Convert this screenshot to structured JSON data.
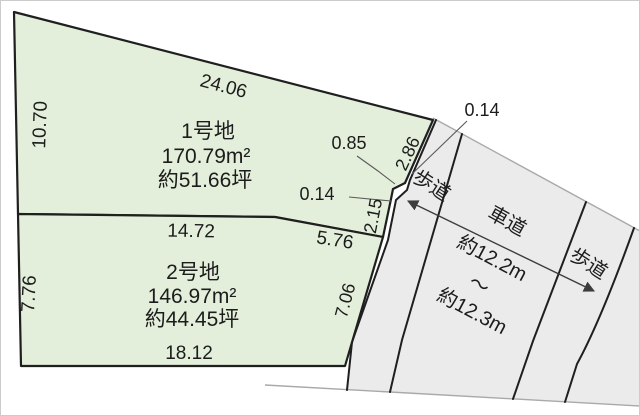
{
  "labels": {
    "dim_top": "24.06",
    "dim_left_plot1": "10.70",
    "plot1_name": "1号地",
    "plot1_area_sqm": "170.79m²",
    "plot1_area_tsubo": "約51.66坪",
    "dim_085": "0.85",
    "dim_286": "2.86",
    "dim_014_top": "0.14",
    "dim_014_left": "0.14",
    "dim_215": "2.15",
    "sidewalk_left": "歩道",
    "roadway": "車道",
    "sidewalk_right": "歩道",
    "road_width_top": "約12.2m",
    "road_width_tilde": "〜",
    "road_width_bottom": "約12.3m",
    "dim_1472": "14.72",
    "dim_576": "5.76",
    "dim_left_plot2": "7.76",
    "dim_706": "7.06",
    "dim_bottom": "18.12",
    "plot2_name": "2号地",
    "plot2_area_sqm": "146.97m²",
    "plot2_area_tsubo": "約44.45坪"
  },
  "colors": {
    "plot_fill": "#e4efdb",
    "road_fill": "#ebebeb",
    "outline": "#1f1f1f",
    "light_line": "#a9a9a9",
    "background": "#ffffff"
  }
}
